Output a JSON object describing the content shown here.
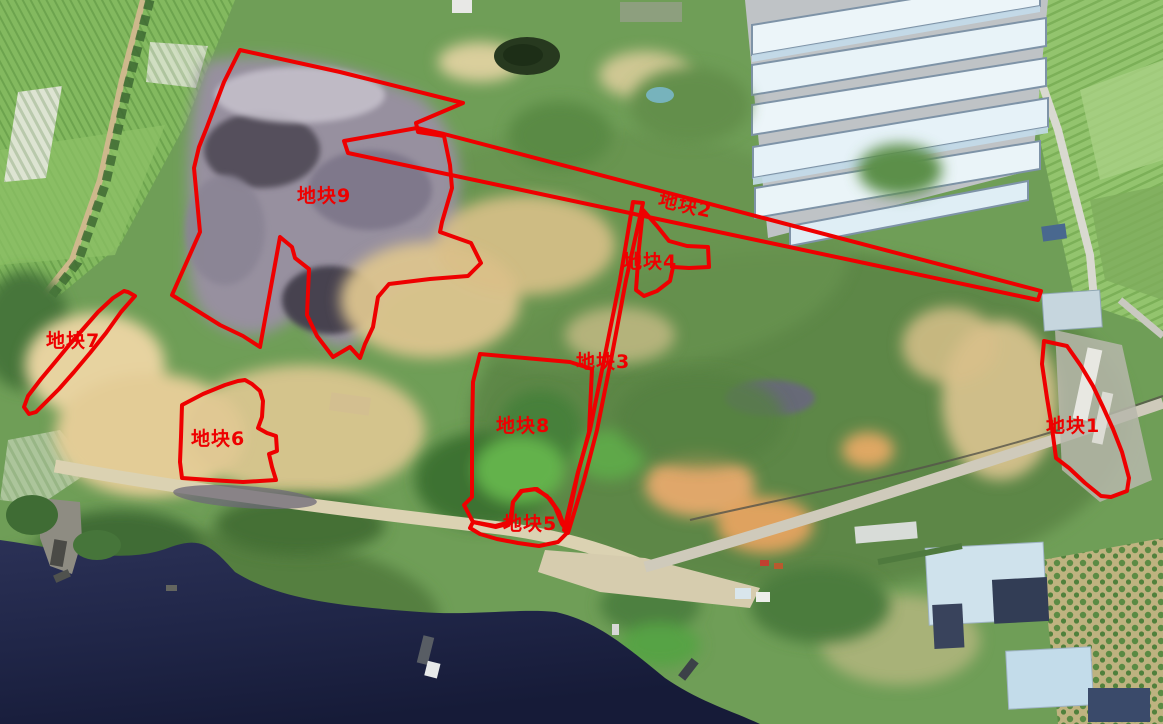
{
  "map": {
    "title": "satellite parcel annotation map",
    "annotation_color": "#ee0000",
    "stroke_width": 4,
    "parcels": [
      {
        "id": "parcel-1",
        "label": "地块1",
        "label_x": 1046,
        "label_y": 416,
        "label_rotation": 0,
        "points": "1044,341 1053,343 1067,346 1081,366 1093,386 1103,407 1113,429 1122,452 1129,478 1127,491 1111,497 1101,496 1085,483 1069,468 1056,458 1052,428 1047,398 1042,364"
      },
      {
        "id": "parcel-2",
        "label": "地块2",
        "label_x": 661,
        "label_y": 190,
        "label_rotation": 13,
        "points": "344,141 417,128 444,134 1041,291 1038,300 348,153"
      },
      {
        "id": "parcel-3",
        "label": "地块3",
        "label_x": 576,
        "label_y": 352,
        "label_rotation": 0,
        "points": "633,202 643,203 626,280 611,360 597,430 584,480 568,533 564,530 578,472 590,430 604,360 620,280"
      },
      {
        "id": "parcel-4",
        "label": "地块4",
        "label_x": 623,
        "label_y": 252,
        "label_rotation": 0,
        "points": "643,210 657,226 669,241 687,246 708,247 709,267 689,268 673,267 670,281 657,291 644,296 636,290 639,248"
      },
      {
        "id": "parcel-5",
        "label": "地块5",
        "label_x": 503,
        "label_y": 514,
        "label_rotation": 0,
        "points": "473,522 496,527 511,523 513,502 522,491 537,489 550,499 559,512 564,526 567,533 558,542 539,546 518,543 497,539 480,534 470,528"
      },
      {
        "id": "parcel-6",
        "label": "地块6",
        "label_x": 191,
        "label_y": 429,
        "label_rotation": 0,
        "points": "238,381 245,380 252,384 260,391 263,401 262,417 258,428 267,433 276,436 277,451 269,454 272,467 276,480 243,482 210,480 182,478 180,462 181,437 182,405 203,394 225,385"
      },
      {
        "id": "parcel-7",
        "label": "地块7",
        "label_x": 46,
        "label_y": 331,
        "label_rotation": 0,
        "points": "128,292 135,296 121,312 106,333 90,353 74,372 59,389 46,402 36,412 29,414 24,407 28,396 41,379 56,361 70,344 84,328 98,312 113,298 124,291"
      },
      {
        "id": "parcel-8",
        "label": "地块8",
        "label_x": 496,
        "label_y": 416,
        "label_rotation": 0,
        "points": "480,354 570,362 592,369 589,432 578,473 566,529 562,524 555,507 547,496 535,489 521,491 513,502 510,522 495,526 473,522 464,505 472,497 472,430 473,382"
      },
      {
        "id": "parcel-9",
        "label": "地块9",
        "label_x": 297,
        "label_y": 186,
        "label_rotation": 0,
        "points": "240,50 340,72 463,103 416,123 418,132 444,136 450,165 452,188 442,222 440,232 471,243 481,263 468,276 430,279 389,284 378,297 373,327 365,344 360,358 350,347 333,357 317,336 307,315 309,269 295,258 292,247 280,237 260,347 243,336 220,325 196,310 172,295 200,232 194,168 199,147 207,127 224,82"
      }
    ]
  }
}
